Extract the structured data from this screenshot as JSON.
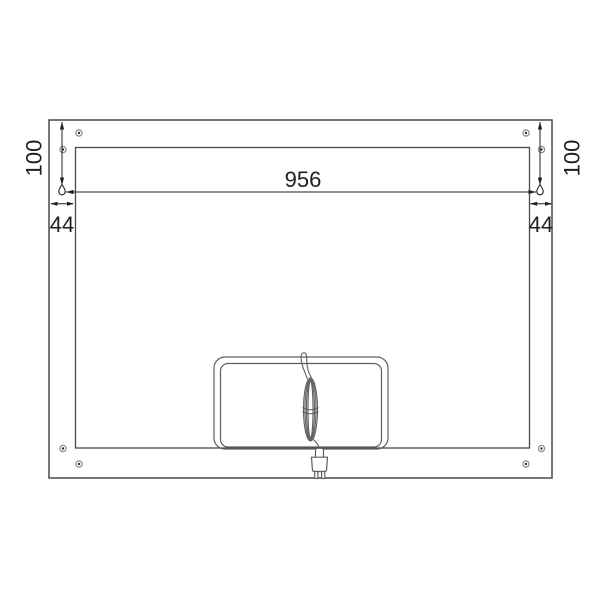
{
  "drawing": {
    "labels": {
      "width_between_hangers": "956",
      "hanger_inset_left": "44",
      "hanger_inset_right": "44",
      "hanger_drop_left": "100",
      "hanger_drop_right": "100"
    },
    "colors": {
      "background": "#ffffff",
      "panel_line": "#4a4a4a",
      "detail_line": "#5f5f5f",
      "dimension_line": "#1f1f1f",
      "screw_ring": "#8a8a8a",
      "screw_dot": "#2f2f2f"
    },
    "icons": {
      "keyhole_left": "keyhole-hanger-icon",
      "keyhole_right": "keyhole-hanger-icon",
      "corner_screws": "screw-icon",
      "power_cord": "coiled-cable-icon",
      "plug": "power-plug-icon"
    }
  }
}
